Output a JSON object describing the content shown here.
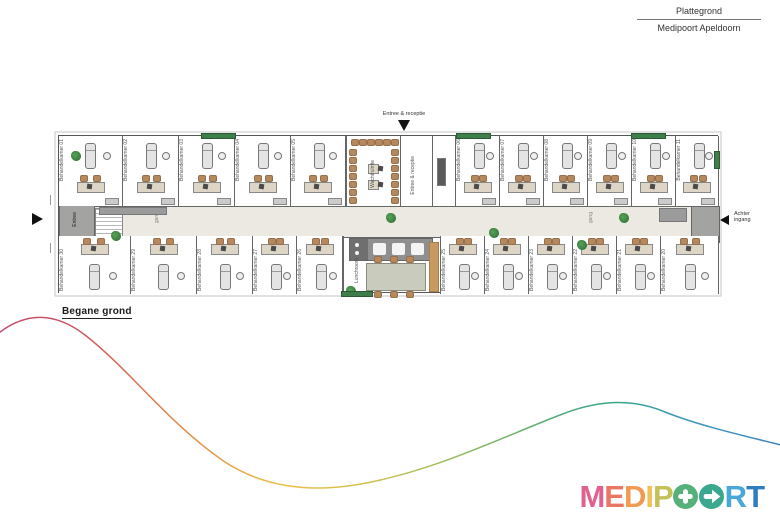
{
  "header": {
    "line1": "Plattegrond",
    "line2": "Medipoort Apeldoorn"
  },
  "floor_label": "Begane grond",
  "entrances": {
    "top": "Entree & receptie",
    "left": "Entree",
    "right1": "Achter",
    "right2": "ingang"
  },
  "areas": {
    "waiting": "Wachtruimte",
    "entree_receptie": "Entree & receptie",
    "lunch": "Lunchroom",
    "corridor": "gang"
  },
  "plan": {
    "top_rooms": [
      {
        "x": 58,
        "w": 64,
        "label": "Behandelkamer 01"
      },
      {
        "x": 122,
        "w": 56,
        "label": "Behandelkamer 02"
      },
      {
        "x": 178,
        "w": 56,
        "label": "Behandelkamer 03"
      },
      {
        "x": 234,
        "w": 56,
        "label": "Behandelkamer 04"
      },
      {
        "x": 290,
        "w": 55,
        "label": "Behandelkamer 05"
      },
      {
        "x": 455,
        "w": 44,
        "label": "Behandelkamer 06"
      },
      {
        "x": 499,
        "w": 44,
        "label": "Behandelkamer 07"
      },
      {
        "x": 543,
        "w": 44,
        "label": "Behandelkamer 08"
      },
      {
        "x": 587,
        "w": 44,
        "label": "Behandelkamer 09"
      },
      {
        "x": 631,
        "w": 44,
        "label": "Behandelkamer 10"
      },
      {
        "x": 675,
        "w": 43,
        "label": "Behandelkamer 11"
      }
    ],
    "bottom_rooms": [
      {
        "x": 58,
        "w": 72,
        "label": "Behandelkamer 30"
      },
      {
        "x": 130,
        "w": 66,
        "label": "Behandelkamer 29"
      },
      {
        "x": 196,
        "w": 56,
        "label": "Behandelkamer 28"
      },
      {
        "x": 252,
        "w": 44,
        "label": "Behandelkamer 27"
      },
      {
        "x": 296,
        "w": 46,
        "label": "Behandelkamer 26"
      },
      {
        "x": 440,
        "w": 44,
        "label": "Behandelkamer 25"
      },
      {
        "x": 484,
        "w": 44,
        "label": "Behandelkamer 24"
      },
      {
        "x": 528,
        "w": 44,
        "label": "Behandelkamer 23"
      },
      {
        "x": 572,
        "w": 44,
        "label": "Behandelkamer 22"
      },
      {
        "x": 616,
        "w": 44,
        "label": "Behandelkamer 21"
      },
      {
        "x": 660,
        "w": 58,
        "label": "Behandelkamer 20"
      }
    ],
    "plants": [
      {
        "x": 12,
        "y": 15
      },
      {
        "x": 52,
        "y": 95
      },
      {
        "x": 327,
        "y": 77
      },
      {
        "x": 518,
        "y": 104
      },
      {
        "x": 560,
        "y": 77
      },
      {
        "x": 287,
        "y": 150
      },
      {
        "x": 430,
        "y": 92
      }
    ],
    "planters": [
      {
        "x": 142,
        "y": -3,
        "w": 33,
        "h": 4
      },
      {
        "x": 397,
        "y": -3,
        "w": 33,
        "h": 4
      },
      {
        "x": 572,
        "y": -3,
        "w": 33,
        "h": 4
      },
      {
        "x": 282,
        "y": 155,
        "w": 30,
        "h": 4
      },
      {
        "x": 655,
        "y": 15,
        "w": 4,
        "h": 16
      }
    ]
  },
  "colors": {
    "corridor": "#ece9e2",
    "wall": "#666666",
    "planter": "#3f7d4a",
    "entry_block": "#a3a3a1"
  },
  "wave": {
    "path": "M -5 336 C 20 315 50 308 85 335 C 130 370 170 425 225 462 C 265 488 310 492 355 485 C 430 473 500 438 560 415 C 595 401 630 397 665 412 C 700 426 745 436 785 446",
    "stops": [
      {
        "o": "0",
        "c": "#c24a6b"
      },
      {
        "o": "0.1",
        "c": "#cd5560"
      },
      {
        "o": "0.22",
        "c": "#df8447"
      },
      {
        "o": "0.36",
        "c": "#ecbe4b"
      },
      {
        "o": "0.48",
        "c": "#cfc253"
      },
      {
        "o": "0.6",
        "c": "#8cba60"
      },
      {
        "o": "0.72",
        "c": "#4fab7c"
      },
      {
        "o": "0.8",
        "c": "#38a38e"
      },
      {
        "o": "0.9",
        "c": "#4096c2"
      },
      {
        "o": "1",
        "c": "#3d7ebd"
      }
    ]
  },
  "logo": {
    "letters": [
      {
        "t": "M",
        "c": "#e2608d"
      },
      {
        "t": "E",
        "c": "#ea7764"
      },
      {
        "t": "D",
        "c": "#f09a52"
      },
      {
        "t": "I",
        "c": "#f2c155"
      },
      {
        "t": "P",
        "c": "#c6c058"
      },
      {
        "t": "O",
        "c": "#55b07a",
        "icon": "plus"
      },
      {
        "t": "O",
        "c": "#3aa78f",
        "icon": "arrow"
      },
      {
        "t": "R",
        "c": "#4aa7da"
      },
      {
        "t": "T",
        "c": "#2e7dbe"
      }
    ]
  }
}
